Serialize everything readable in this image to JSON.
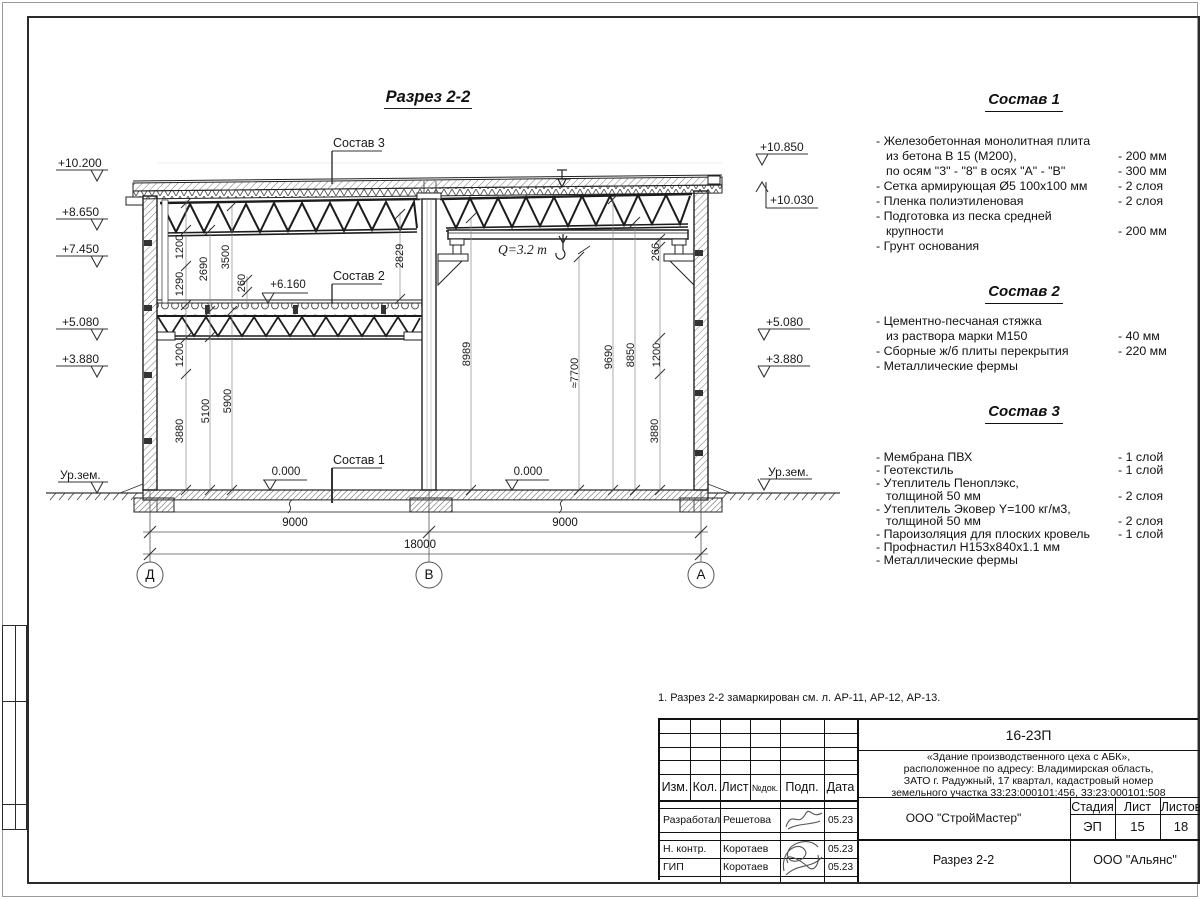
{
  "drawing": {
    "title": "Разрез 2-2",
    "marks_left": {
      "m1": "+10.200",
      "m2": "+8.650",
      "m3": "+7.450",
      "m4": "+5.080",
      "m5": "+3.880",
      "m6": "Ур.зем."
    },
    "marks_right": {
      "m1": "+10.850",
      "m2": "+10.030",
      "m3": "+5.080",
      "m4": "+3.880",
      "m5": "Ур.зем."
    },
    "levels": {
      "zero_left": "0.000",
      "zero_right": "0.000",
      "mezz": "+6.160"
    },
    "layer_labels": {
      "s1": "Состав 1",
      "s2": "Состав 2",
      "s3": "Состав 3"
    },
    "crane_capacity": "Q=3.2 т",
    "dims": {
      "a1200": "1200",
      "a2690": "2690",
      "a3500": "3500",
      "a1290": "1290",
      "a260": "260",
      "a2829": "2829",
      "b1200": "1200",
      "b5100": "5100",
      "b5900": "5900",
      "b3880": "3880",
      "c8989": "8989",
      "c7700": "≈7700",
      "c9690": "9690",
      "c8850": "8850",
      "c1200": "1200",
      "c266": "266",
      "c3880": "3880",
      "span_left": "9000",
      "span_right": "9000",
      "span_total": "18000"
    },
    "axes": {
      "left": "Д",
      "mid": "В",
      "right": "А"
    }
  },
  "specs": [
    {
      "title": "Состав 1",
      "items": [
        {
          "t": "- Железобетонная  монолитная плита",
          "v": ""
        },
        {
          "t": "из бетона В 15 (М200),",
          "v": "- 200 мм"
        },
        {
          "t": "по осям \"3\" - \"8\" в осях \"А\" - \"В\"",
          "v": "- 300 мм"
        },
        {
          "t": "- Сетка армирующая Ø5 100х100 мм",
          "v": "- 2 слоя"
        },
        {
          "t": "- Пленка полиэтиленовая",
          "v": "-  2 слоя"
        },
        {
          "t": "- Подготовка из песка средней",
          "v": ""
        },
        {
          "t": "крупности",
          "v": "- 200 мм"
        },
        {
          "t": "- Грунт основания",
          "v": ""
        }
      ]
    },
    {
      "title": "Состав 2",
      "items": [
        {
          "t": "- Цементно-песчаная стяжка",
          "v": ""
        },
        {
          "t": "из раствора марки М150",
          "v": "- 40 мм"
        },
        {
          "t": "- Сборные ж/б плиты перекрытия",
          "v": "- 220 мм"
        },
        {
          "t": "- Металлические фермы",
          "v": ""
        }
      ]
    },
    {
      "title": "Состав 3",
      "items": [
        {
          "t": "- Мембрана ПВХ",
          "v": "- 1 слой"
        },
        {
          "t": "- Геотекстиль",
          "v": "- 1 слой"
        },
        {
          "t": "- Утеплитель Пеноплэкс,",
          "v": ""
        },
        {
          "t": "толщиной 50 мм",
          "v": "- 2 слоя"
        },
        {
          "t": "- Утеплитель Эковер Y=100 кг/м3,",
          "v": ""
        },
        {
          "t": "толщиной 50 мм",
          "v": "- 2 слоя"
        },
        {
          "t": "- Пароизоляция для плоских кровель",
          "v": "- 1 слой"
        },
        {
          "t": "- Профнастил Н153х840х1.1 мм",
          "v": ""
        },
        {
          "t": "- Металлические фермы",
          "v": ""
        }
      ]
    }
  ],
  "note": "1. Разрез 2-2 замаркирован см. л. АР-11, АР-12, АР-13.",
  "titleblock": {
    "doc_number": "16-23П",
    "description": [
      "«Здание производственного цеха с АБК»,",
      "расположенное по адресу: Владимирская область,",
      "ЗАТО г. Радужный, 17 квартал, кадастровый номер",
      "земельного участка 33:23:000101:456, 33:23:000101:508"
    ],
    "columns": {
      "izm": "Изм.",
      "kol": "Кол.",
      "list": "Лист",
      "ndok": "№док.",
      "podp": "Подп.",
      "data": "Дата"
    },
    "rows": [
      {
        "role": "Разработал",
        "name": "Решетова",
        "date": "05.23"
      },
      {
        "role": "Н. контр.",
        "name": "Коротаев",
        "date": "05.23"
      },
      {
        "role": "ГИП",
        "name": "Коротаев",
        "date": "05.23"
      }
    ],
    "org": "ООО \"СтройМастер\"",
    "stage_label": "Стадия",
    "sheet_label": "Лист",
    "sheets_label": "Листов",
    "stage": "ЭП",
    "sheet": "15",
    "sheets": "18",
    "drawing_name": "Разрез 2-2",
    "contractor": "ООО \"Альянс\""
  }
}
